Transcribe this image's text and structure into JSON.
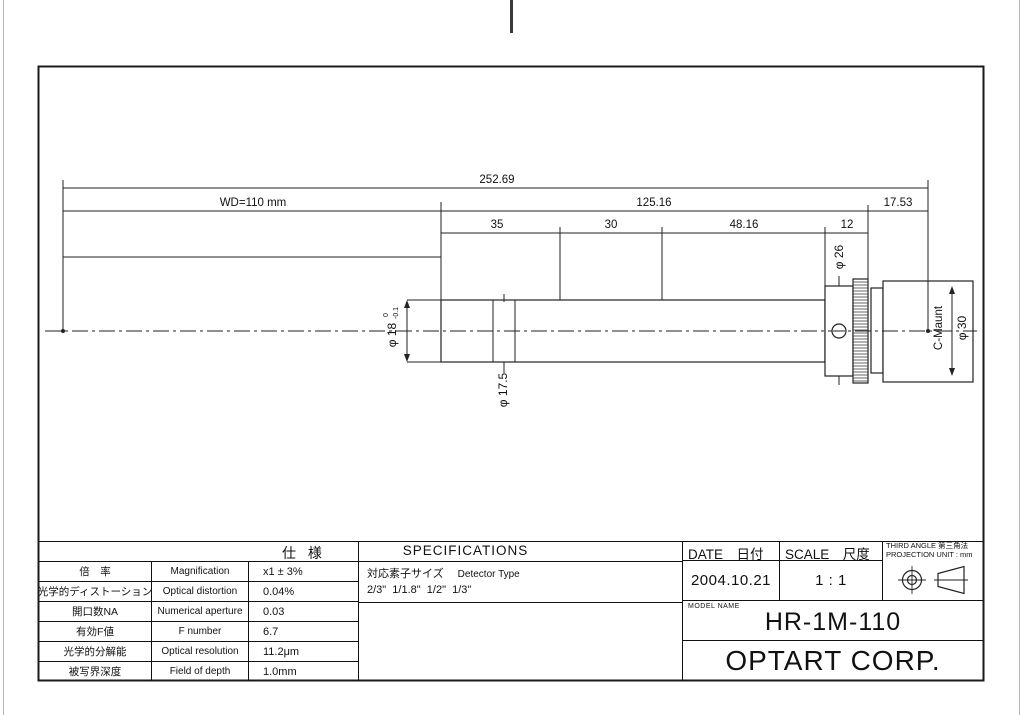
{
  "drawing": {
    "dims": {
      "total": "252.69",
      "wd": "WD=110 mm",
      "seg_125": "125.16",
      "seg_1753": "17.53",
      "seg_35": "35",
      "seg_30": "30",
      "seg_4816": "48.16",
      "seg_12": "12",
      "dia_18": "φ 18",
      "dia_18_tol_upper": "0",
      "dia_18_tol_lower": "-0.1",
      "dia_175": "φ 17.5",
      "dia_26": "φ 26",
      "dia_30": "φ 30",
      "cmount": "C-Maunt"
    }
  },
  "spec_table": {
    "title": "仕 様",
    "rows": [
      {
        "jp": "倍　率",
        "en": "Magnification",
        "value": "x1 ± 3%"
      },
      {
        "jp": "光学的ディストーション",
        "en": "Optical distortion",
        "value": "0.04%"
      },
      {
        "jp": "開口数NA",
        "en": "Numerical aperture",
        "value": "0.03"
      },
      {
        "jp": "有効F値",
        "en": "F number",
        "value": "6.7"
      },
      {
        "jp": "光学的分解能",
        "en": "Optical resolution",
        "value": "11.2μm"
      },
      {
        "jp": "被写界深度",
        "en": "Field of depth",
        "value": "1.0mm"
      }
    ]
  },
  "specifications": {
    "title": "SPECIFICATIONS",
    "detector_label_jp": "対応素子サイズ",
    "detector_label_en": "Detector Type",
    "detector_sizes": "2/3\"  1/1.8\"  1/2\"  1/3\""
  },
  "titleblock": {
    "date_label": "DATE　日付",
    "date_value": "2004.10.21",
    "scale_label": "SCALE　尺度",
    "scale_value": "1 : 1",
    "projection_line1": "THIRD ANGLE 第三角法",
    "projection_line2": "PROJECTION UNIT : mm",
    "model_label": "MODEL NAME",
    "model_value": "HR-1M-110",
    "company": "OPTART CORP."
  }
}
